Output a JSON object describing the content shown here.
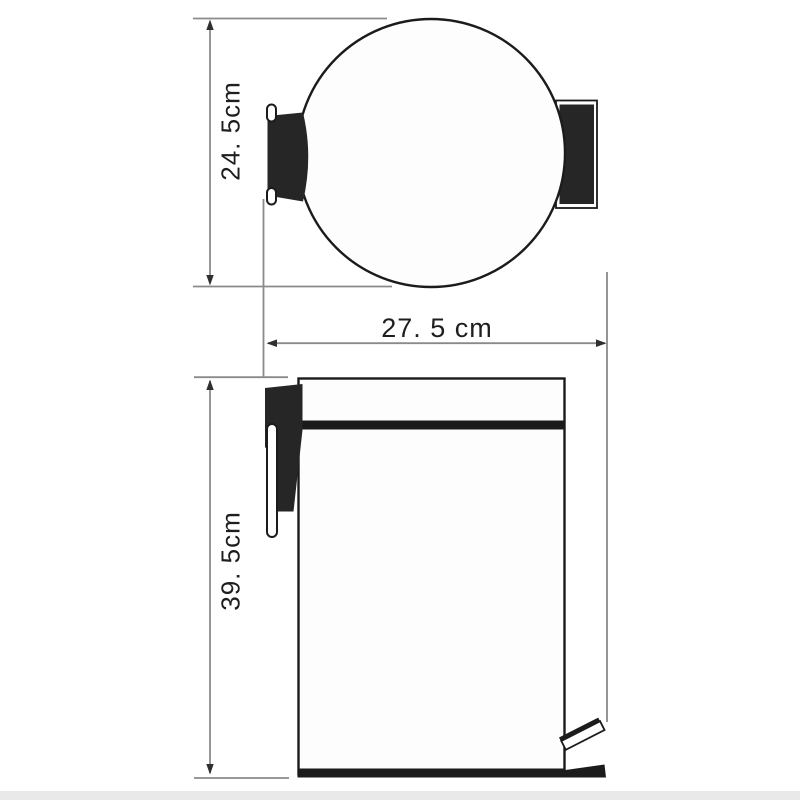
{
  "diagram": {
    "type": "product-dimension-drawing",
    "subject": "pedal waste bin, top view and front view",
    "dimensions": {
      "top_view_depth": "24. 5cm",
      "width": "27. 5 cm",
      "front_height": "39. 5cm"
    },
    "colors": {
      "ink": "#1b1b1b",
      "dark_fill": "#262626",
      "dimension_line": "#8a8a8a",
      "arrow": "#2f2f2f",
      "paper": "#ffffff",
      "bottom_band": "#e9e9e9"
    }
  }
}
